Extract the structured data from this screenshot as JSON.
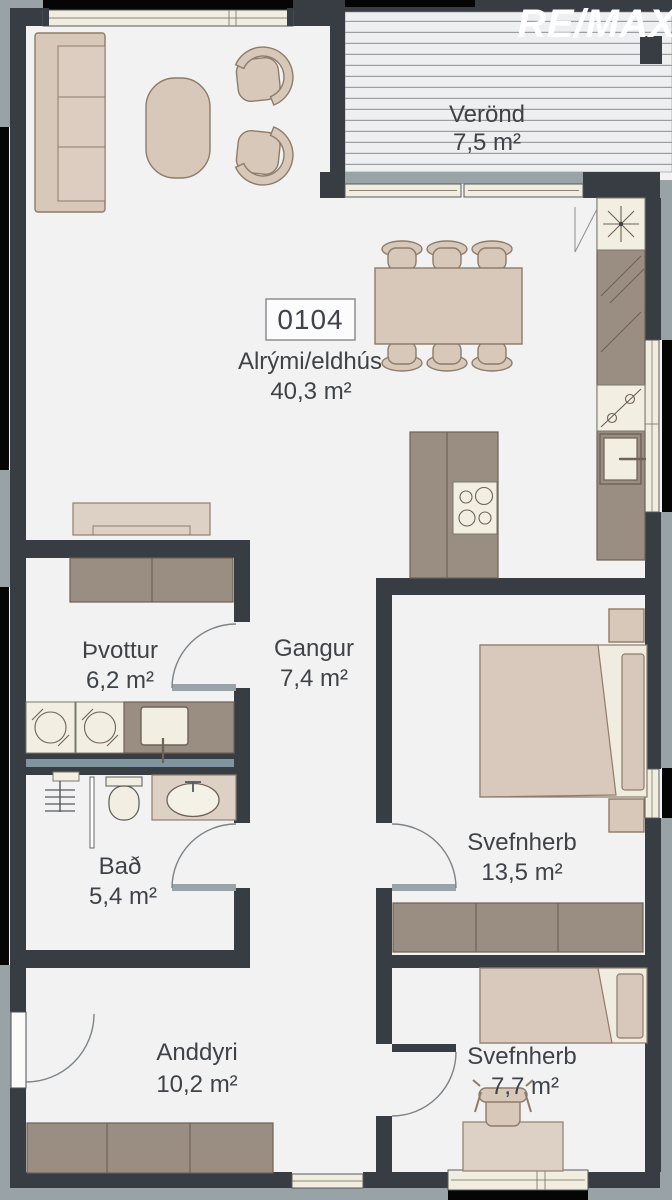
{
  "logo": {
    "text": "RE/MAX"
  },
  "unit": {
    "number": "0104"
  },
  "rooms": {
    "verond": {
      "name": "Verönd",
      "area": "7,5 m²"
    },
    "alrymi": {
      "name": "Alrými/eldhús",
      "area": "40,3 m²"
    },
    "thvottur": {
      "name": "Þvottur",
      "area": "6,2 m²"
    },
    "gangur": {
      "name": "Gangur",
      "area": "7,4 m²"
    },
    "bad": {
      "name": "Bað",
      "area": "5,4 m²"
    },
    "svefnherb_main": {
      "name": "Svefnherb",
      "area": "13,5 m²"
    },
    "anddyri": {
      "name": "Anddyri",
      "area": "10,2 m²"
    },
    "svefnherb_small": {
      "name": "Svefnherb",
      "area": "7,7 m²"
    }
  },
  "colors": {
    "wall": "#383d44",
    "floor": "#f2f2f3",
    "furniture": "#d7c8ba",
    "cabinet": "#9a8d81",
    "appliance_cream": "#f2efe2",
    "exterior_trim": "#99a3a7",
    "plumbing_stripe": "#7f96a1",
    "logo_text": "#ffffff"
  }
}
